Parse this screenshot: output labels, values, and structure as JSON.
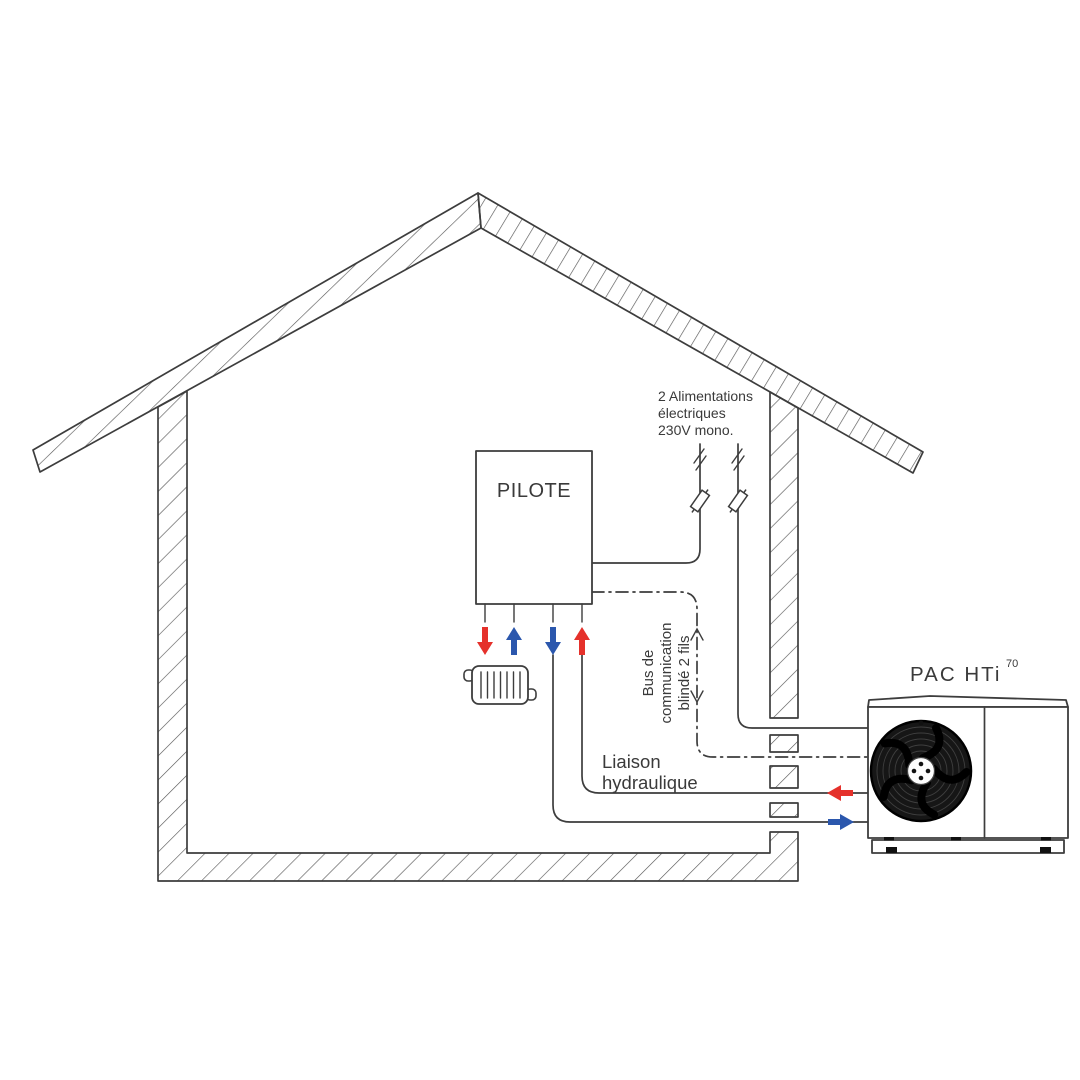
{
  "diagram": {
    "power_supply_label": {
      "line1": "2 Alimentations",
      "line2": "électriques",
      "line3": "230V mono."
    },
    "pilot_box_label": "PILOTE",
    "bus_label": {
      "line1": "Bus de",
      "line2": "communication",
      "line3": "blindé 2 fils"
    },
    "hydraulic_label": {
      "line1": "Liaison",
      "line2": "hydraulique"
    },
    "heat_pump_label": {
      "name": "PAC HTi",
      "model_sup": "70"
    }
  },
  "colors": {
    "line": "#3d3d3d",
    "hot": "#e5312b",
    "cold": "#2b57ad"
  }
}
